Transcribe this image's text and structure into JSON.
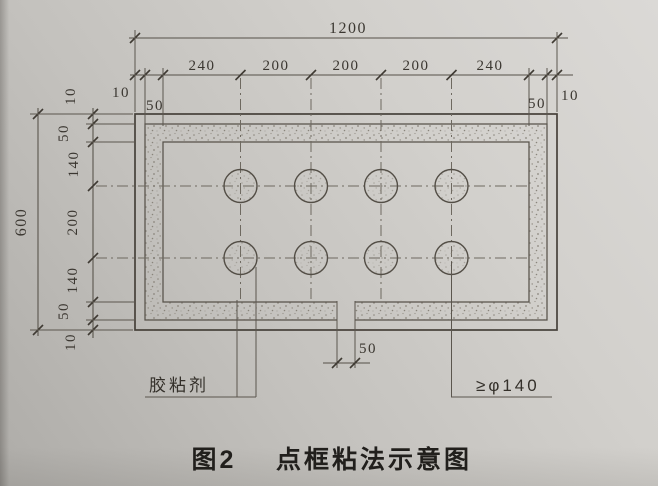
{
  "figure": {
    "caption": {
      "number": "图2",
      "title": "点框粘法示意图"
    },
    "callouts": {
      "adhesive": "胶粘剂",
      "dot_diameter": "≥φ140"
    },
    "dimensions": {
      "top_total": "1200",
      "top_row": {
        "margin_left": "10",
        "band_left": "50",
        "segments": [
          "240",
          "200",
          "200",
          "200",
          "240"
        ],
        "band_right": "50",
        "margin_right": "10"
      },
      "left_total": "600",
      "left_col": {
        "segments": [
          "10",
          "50",
          "140",
          "200",
          "140",
          "50",
          "10"
        ]
      },
      "bottom_gap": "50"
    },
    "colors": {
      "paper": "#cfcdc9",
      "ink": "#4c473f",
      "caption_ink": "#211f1c"
    }
  }
}
